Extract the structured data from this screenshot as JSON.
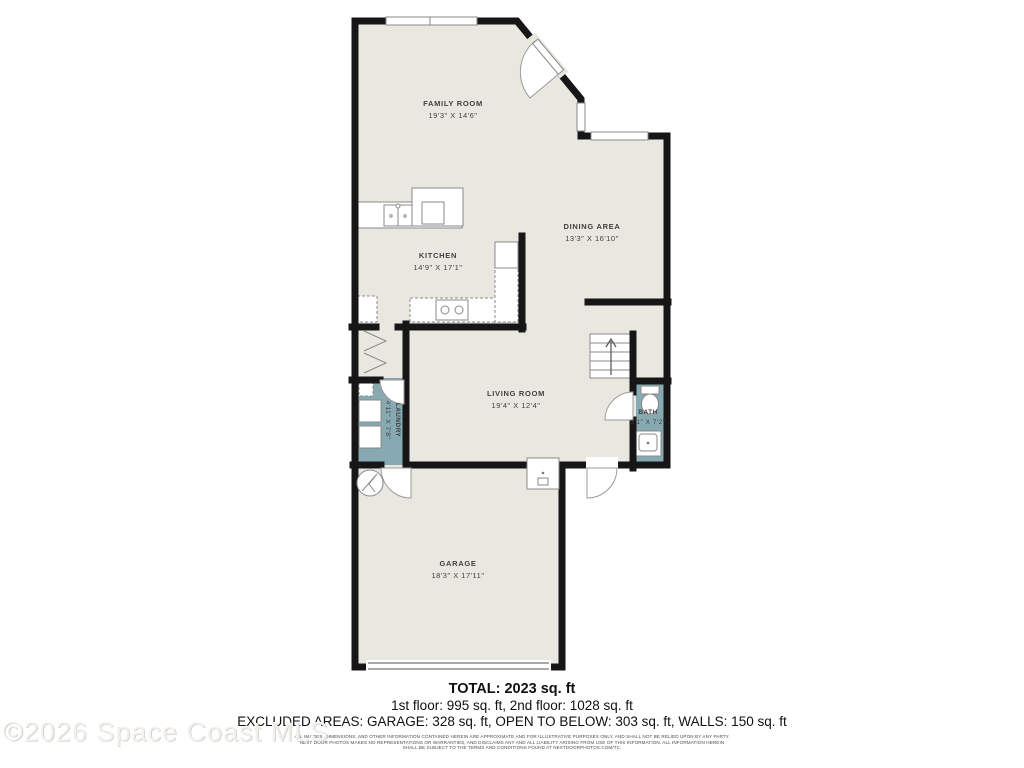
{
  "colors": {
    "floor": "#e9e8e0",
    "wet": "#87a9b1",
    "wall": "#161616",
    "fixture_stroke": "#8a8a8a"
  },
  "rooms": {
    "family": {
      "name": "FAMILY ROOM",
      "dims": "19'3\" X 14'6\""
    },
    "dining": {
      "name": "DINING AREA",
      "dims": "13'3\" X 16'10\""
    },
    "kitchen": {
      "name": "KITCHEN",
      "dims": "14'9\" X 17'1\""
    },
    "living": {
      "name": "LIVING ROOM",
      "dims": "19'4\" X 12'4\""
    },
    "laundry": {
      "name": "LAUNDRY",
      "dims": "4'11\" X 7'8\""
    },
    "bath": {
      "name": "BATH",
      "dims": "3'1\" X 7'2\""
    },
    "garage": {
      "name": "GARAGE",
      "dims": "18'3\" X 17'11\""
    }
  },
  "summary": {
    "total": "TOTAL: 2023 sq. ft",
    "floors": "1st floor: 995 sq. ft, 2nd floor: 1028 sq. ft",
    "excluded": "EXCLUDED AREAS: GARAGE: 328 sq. ft, OPEN TO BELOW: 303 sq. ft, WALLS: 150 sq. ft"
  },
  "disclaimer": {
    "line1": "ALL IMAGES, DIMENSIONS, AND OTHER INFORMATION CONTAINED HEREIN ARE APPROXIMATE AND FOR ILLUSTRATIVE PURPOSES ONLY, AND SHALL NOT BE RELIED UPON BY ANY PARTY.",
    "line2": "NEXT DOOR PHOTOS MAKES NO REPRESENTATIONS OR WARRANTIES, AND DISCLAIMS ANY AND ALL LIABILITY ARISING FROM USE OF THIS INFORMATION. ALL INFORMATION HEREIN",
    "line3": "SHALL BE SUBJECT TO THE TERMS AND CONDITIONS FOUND AT NEXTDOORPHOTOS.COM/TC."
  },
  "watermark": "©2026 Space Coast MLS"
}
